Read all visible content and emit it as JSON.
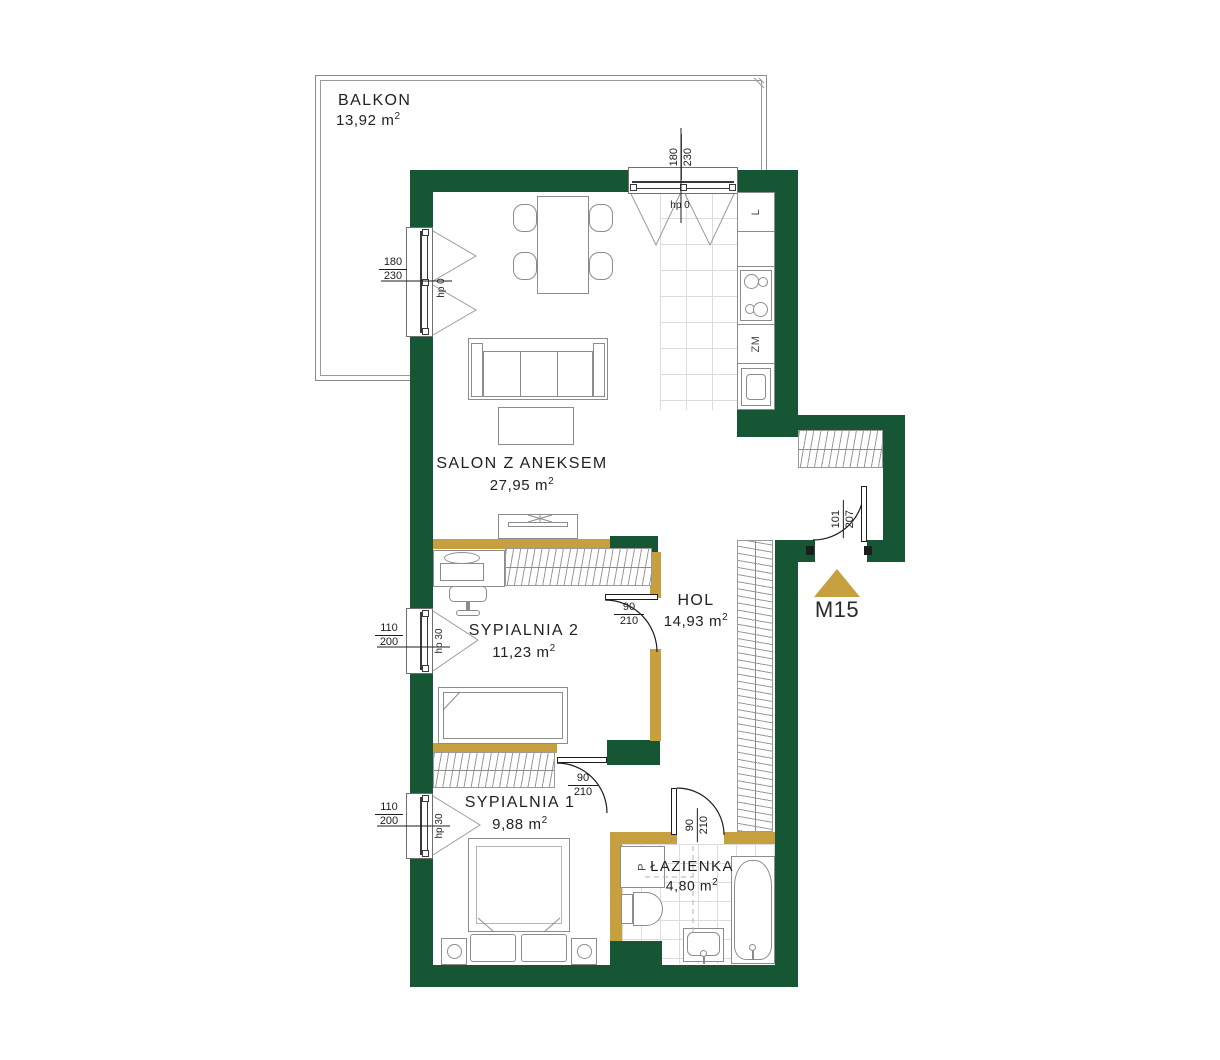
{
  "marker": {
    "label": "M15"
  },
  "unit": {
    "base": "m",
    "sup": "2"
  },
  "rooms": {
    "balkon": {
      "name": "BALKON",
      "area": "13,92"
    },
    "salon": {
      "name": "SALON Z ANEKSEM",
      "area": "27,95"
    },
    "sypialnia2": {
      "name": "SYPIALNIA 2",
      "area": "11,23"
    },
    "hol": {
      "name": "HOL",
      "area": "14,93"
    },
    "sypialnia1": {
      "name": "SYPIALNIA 1",
      "area": "9,88"
    },
    "lazienka": {
      "name": "ŁAZIENKA",
      "area": "4,80"
    }
  },
  "windows": {
    "salonLeft": {
      "w": "180",
      "h": "230",
      "hp": "hp 0"
    },
    "kitchenTop": {
      "w": "180",
      "h": "230",
      "hp": "hp 0"
    },
    "syp2Left": {
      "w": "110",
      "h": "200",
      "hp": "hp 30"
    },
    "syp1Left": {
      "w": "110",
      "h": "200",
      "hp": "hp 30"
    }
  },
  "doors": {
    "syp2": {
      "w": "90",
      "h": "210"
    },
    "syp1": {
      "w": "90",
      "h": "210"
    },
    "bath": {
      "w": "90",
      "h": "210"
    },
    "entry": {
      "w": "101",
      "h": "207"
    }
  },
  "kitchen": {
    "fridge": "L",
    "dishwasher": "ZM"
  },
  "bathroom": {
    "washer": "P"
  },
  "colors": {
    "wall": "#175635",
    "partition": "#c6a03f",
    "marker": "#c6a03f"
  }
}
